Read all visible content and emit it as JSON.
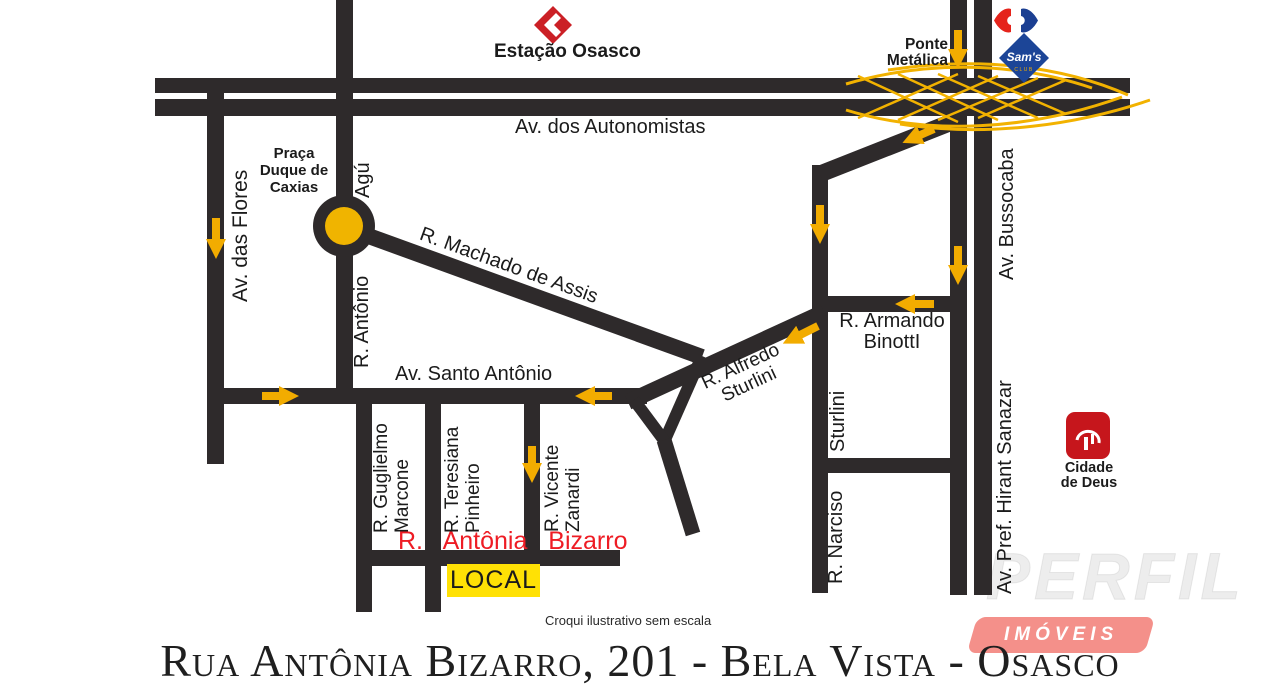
{
  "colors": {
    "road": "#2e2a2b",
    "accent_yellow": "#F2AC00",
    "roundabout_yellow": "#F0B400",
    "local_yellow": "#FFE105",
    "street_red": "#EE1C24",
    "estacao_red": "#CB2026",
    "carrefour_red": "#E5231B",
    "carrefour_blue": "#1B3F92",
    "sams_blue": "#1C4597",
    "cidade_de_deus_red": "#C6161C",
    "banner_salmon": "#F4908A"
  },
  "landmarks": {
    "estacao": "Estação Osasco",
    "ponte": "Ponte\nMetálica",
    "sams_name": "Sam's",
    "sams_sub": "CLUB",
    "cidade_de_deus": "Cidade\nde Deus",
    "praca": "Praça\nDuque de\nCaxias",
    "local": "LOCAL"
  },
  "streets": {
    "autonomistas": "Av. dos Autonomistas",
    "flores": "Av. das Flores",
    "agu": "Agú",
    "antonio": "R. Antônio",
    "machado": "R. Machado de Assis",
    "santo_antonio": "Av. Santo Antônio",
    "alfredo_sturlini": "R. Alfredo\nSturlini",
    "armando_binotti": "R. Armando\nBinottI",
    "sturlini": "Sturlini",
    "narciso": "R. Narciso",
    "bussocaba": "Av. Bussocaba",
    "hirant_sanazar": "Av. Pref. Hirant Sanazar",
    "guglielmo": "R. Guglielmo\nMarcone",
    "teresiana": "R. Teresiana\nPinheiro",
    "vicente": "R. Vicente\nZanardi",
    "antonia_bizarro": "R. Antônia Bizarro"
  },
  "footer": {
    "note": "Croqui ilustrativo sem escala",
    "address": "Rua Antônia Bizarro, 201 - Bela Vista - Osasco"
  },
  "watermark": {
    "brand": "PERFIL",
    "badge": "IMÓVEIS"
  }
}
